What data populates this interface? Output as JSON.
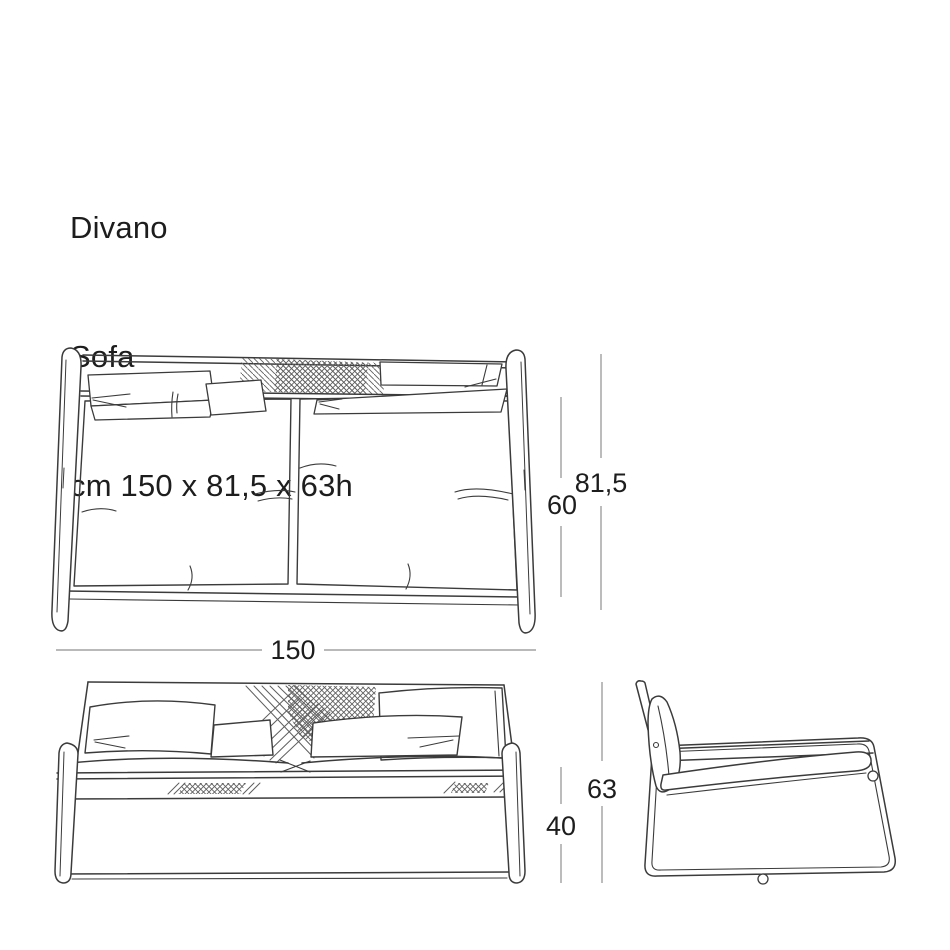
{
  "title": {
    "product_name_it": "Divano",
    "product_name_en": "Sofa",
    "size_summary": "cm 150 x 81,5 x 63h"
  },
  "dimension_labels": {
    "overall_width": "150",
    "seat_depth": "60",
    "overall_depth": "81,5",
    "overall_height": "63",
    "seat_height": "40"
  },
  "colors": {
    "background": "#ffffff",
    "drawing_line": "#3b3b3b",
    "hatch_line": "#5f5f5f",
    "dimension_line": "#8f8f8f",
    "text": "#1d1d1d"
  }
}
